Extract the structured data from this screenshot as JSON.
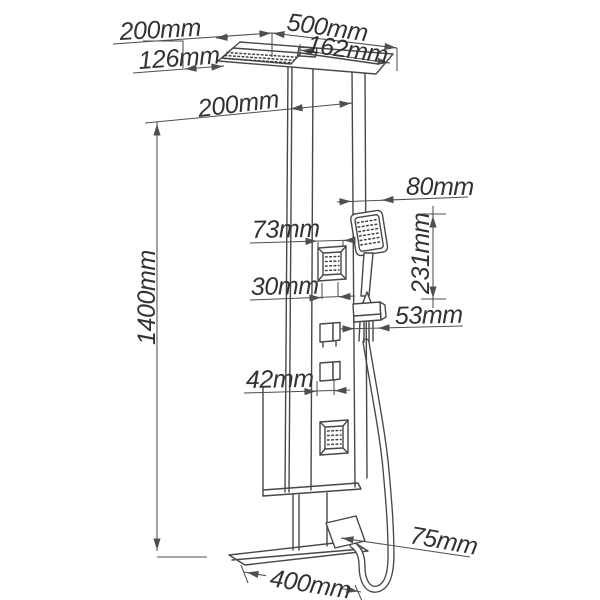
{
  "diagram": {
    "kind": "shower-panel-dimension-drawing",
    "unit": "mm",
    "background_color": "#ffffff",
    "line_color": "#474747",
    "text_color": "#323232"
  },
  "labels": {
    "arm_offset": "200mm",
    "head_length": "500mm",
    "head_width": "162mm",
    "wall_clearance": "126mm",
    "panel_width": "200mm",
    "hand_shower_width": "80mm",
    "jet_width": "73mm",
    "jet_depth": "30mm",
    "hand_shower_height": "231mm",
    "holder_width": "53mm",
    "knob_width": "42mm",
    "panel_height": "1400mm",
    "spout_depth": "75mm",
    "base_width": "400mm"
  },
  "parts": [
    "rain-shower-head",
    "shower-panel-column",
    "body-jet",
    "body-jet",
    "control-knob",
    "control-knob",
    "hand-shower",
    "hand-shower-holder",
    "shower-hose",
    "tub-spout",
    "base-shelf"
  ]
}
